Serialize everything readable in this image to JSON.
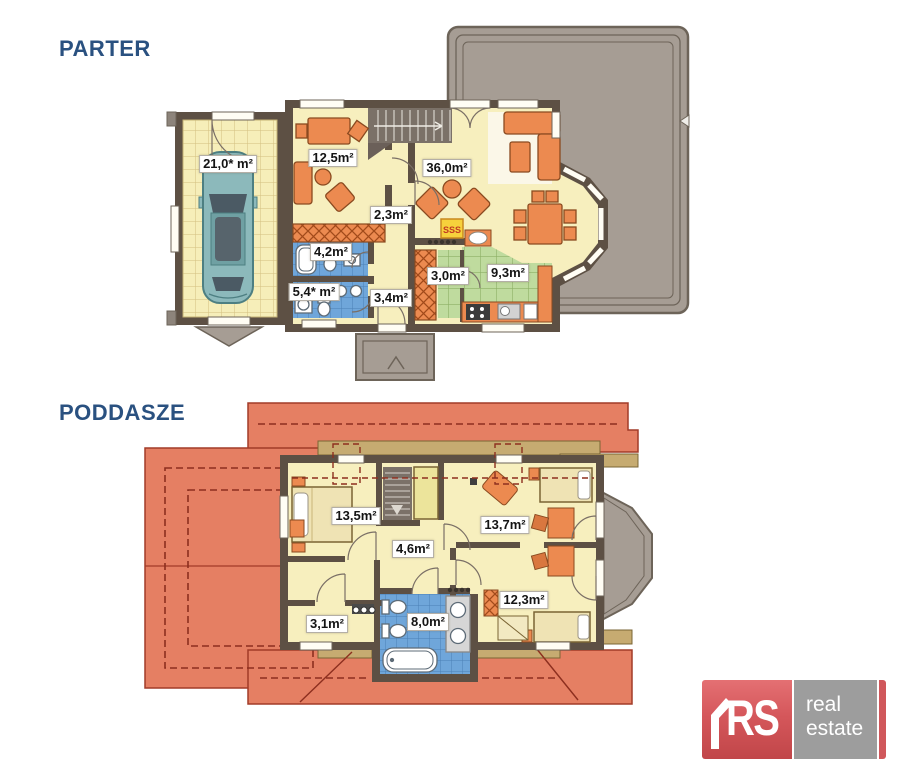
{
  "titles": {
    "ground_floor": "PARTER",
    "attic": "PODDASZE"
  },
  "ground_floor": {
    "rooms": [
      {
        "name": "garage",
        "area": "21,0* m²"
      },
      {
        "name": "room",
        "area": "12,5m²"
      },
      {
        "name": "living-room",
        "area": "36,0m²"
      },
      {
        "name": "hallway",
        "area": "2,3m²"
      },
      {
        "name": "bathroom",
        "area": "4,2m²"
      },
      {
        "name": "bathroom-2",
        "area": "5,4* m²"
      },
      {
        "name": "entry-hall",
        "area": "3,4m²"
      },
      {
        "name": "pantry",
        "area": "3,0m²"
      },
      {
        "name": "kitchen",
        "area": "9,3m²"
      }
    ],
    "fireplace_mark": "SSS"
  },
  "attic": {
    "rooms": [
      {
        "name": "bedroom",
        "area": "13,5m²"
      },
      {
        "name": "hallway",
        "area": "4,6m²"
      },
      {
        "name": "bedroom-2",
        "area": "13,7m²"
      },
      {
        "name": "room",
        "area": "3,1m²"
      },
      {
        "name": "bathroom",
        "area": "8,0m²"
      },
      {
        "name": "bedroom-3",
        "area": "12,3m²"
      }
    ]
  },
  "logo": {
    "monogram": "RS",
    "line1": "real",
    "line2": "estate"
  },
  "colors": {
    "title": "#2a5180",
    "wall": "#5d5044",
    "floor": "#f7efbe",
    "roof": "#e57f63",
    "bathroom": "#6fa6da",
    "kitchen": "#bfdb9e",
    "furniture": "#ec8a50",
    "terrace": "#a69d94",
    "logo_red": "#cf4d51",
    "logo_gray": "#9d9d9d"
  }
}
